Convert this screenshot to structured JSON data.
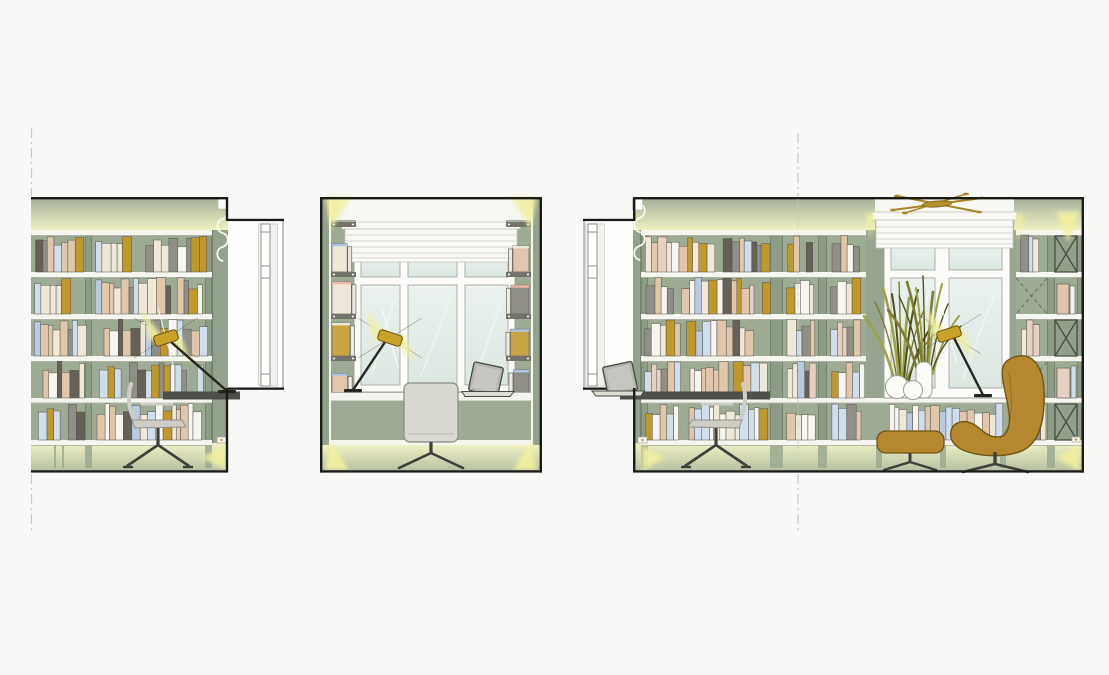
{
  "canvas": {
    "width": 1109,
    "height": 675,
    "background": "#f8f8f6"
  },
  "palette": {
    "line_black": "#1b1b18",
    "sage": "#9dab94",
    "sage_dark": "#93a28c",
    "sage_post": "#8d9c86",
    "post_edge": "#6d7c69",
    "cornice_top": "#a7b29c",
    "cornice_bottom": "#f0f1c3",
    "plinth_top": "#f0f1c6",
    "plinth_bottom": "#b7c2a4",
    "shelf_white": "#f6f6f1",
    "shelf_edge": "#b2b2a8",
    "glow": "#f2f0a0",
    "desk_dark": "#4f4f49",
    "metal_dark": "#3f3f3b",
    "chair_light": "#cdccc5",
    "chair_line": "#93928a",
    "chair_rear": "#d9d8d0",
    "lamp_gold": "#c9a22a",
    "lamp_arm": "#26261f",
    "brass": "#a8872a",
    "glass_top": "#eaf1ee",
    "glass_bottom": "#dce7e2",
    "frame_white": "#fbfbf8",
    "frame_line": "#a0a098",
    "blind_white": "#f8f8f4",
    "blind_line": "#d8d8d0",
    "egg_mustard": "#b5872e",
    "egg_outline": "#6f5514",
    "olive": "#7c7c2d",
    "olive_dark": "#4f4f1c",
    "olive_light": "#9aa344",
    "vase_white": "#fcfcf9",
    "vase_line": "#9d9d95",
    "recess_white": "#fdfdfc",
    "door_line": "#8a8a82",
    "dash_line": "#c9c9c3",
    "cap_gray": "#73736b",
    "laptop_body": "#b7b7b1",
    "book_colors": [
      "#efe8d9",
      "#cfdded",
      "#c1992b",
      "#e0c7ab",
      "#8f8f88",
      "#f7f5ef",
      "#656058",
      "#e6d0c1",
      "#b9cbe3"
    ],
    "book_weights": [
      3,
      2,
      2,
      3,
      2,
      2,
      1,
      1,
      1
    ],
    "side_book_colors": [
      "#e0c7ab",
      "#8f8f88",
      "#c9a443",
      "#efe8d9",
      "#f3f1ea"
    ],
    "side_book_edges": [
      "#e8b9a6",
      "#aac4e2",
      "#eee8d8"
    ]
  },
  "panels": [
    {
      "id": "left-wall-elevation",
      "x": 31,
      "y": 197,
      "width": 197,
      "height": 276,
      "objects": [
        "bookshelf",
        "shelf-lighting",
        "desk",
        "desk-lamp",
        "office-chair",
        "door-reveal",
        "cable-squiggle"
      ]
    },
    {
      "id": "desk-nook-elevation",
      "x": 320,
      "y": 197,
      "width": 222,
      "height": 276,
      "objects": [
        "window",
        "roller-blind",
        "side-bookshelves",
        "desk",
        "laptop",
        "desk-lamp",
        "office-chair",
        "corner-spotlights"
      ]
    },
    {
      "id": "window-wall-elevation",
      "x": 633,
      "y": 197,
      "width": 451,
      "height": 276,
      "objects": [
        "bookshelf",
        "window",
        "roman-blind",
        "brass-ceiling-lamp",
        "vases-with-grass",
        "desk-lamp",
        "desk",
        "laptop",
        "office-chair",
        "egg-chair",
        "footstool",
        "display-cabinet-x-doors",
        "door-reveal"
      ]
    }
  ],
  "reference_lines": [
    {
      "id": "section-line-left",
      "x": 31.5
    },
    {
      "id": "section-line-right",
      "x": 798
    }
  ]
}
